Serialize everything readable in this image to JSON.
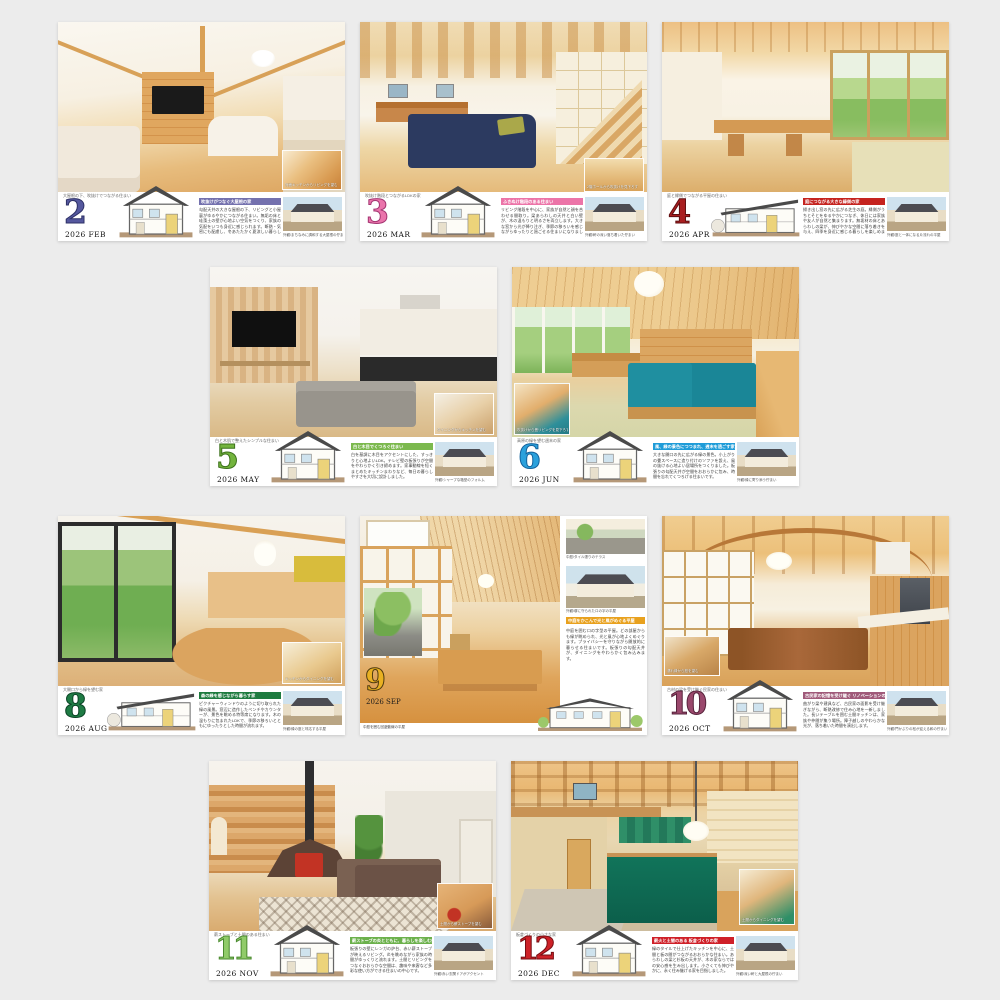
{
  "page": {
    "background": "#ececec",
    "year": "2026"
  },
  "cards": [
    {
      "month_number": "2",
      "date_label": "2026 FEB",
      "number_color": "#55589e",
      "number_outline": "#2e3166",
      "header_color": "#7471ae",
      "top_caption": "大屋根の下、吹抜けでつながる住まい",
      "headline": "吹抜けがつなぐ大屋根の家",
      "body": "勾配天井の大きな屋根の下、リビングと小屋裏がゆるやかにつながる住まい。無垢の床と珪藻土の壁が心地よい空気をつくり、家族の気配をいつも身近に感じられます。断熱・気密にも配慮し、冬あたたかく夏涼しい暮らしを実現しました。",
      "thumb_caption": "外観/まちなみに調和する大屋根の佇まい",
      "inset_caption": "対面キッチンからリビングを望む"
    },
    {
      "month_number": "3",
      "date_label": "2026 MAR",
      "number_color": "#ea74ab",
      "number_outline": "#a43572",
      "header_color": "#ec74a8",
      "top_caption": "吹抜け階段とつながるLDKの家",
      "headline": "ふきぬけ階段のある住まい",
      "body": "リビング階段を中心に、家族が自然と顔を合わせる間取り。梁あらわしの天井と白い壁が、木の温もりと明るさを両立します。大きな窓から光が降り注ぎ、季節の移ろいを感じながらゆったりと過ごせる住まいになりました。",
      "thumb_caption": "外観/軒の深い落ち着いた佇まい",
      "inset_caption": "2階ホールから吹抜けを見下ろす"
    },
    {
      "month_number": "4",
      "date_label": "2026 APR",
      "number_color": "#a91e20",
      "number_outline": "#5f0e10",
      "header_color": "#c5231f",
      "top_caption": "庭と縁側でつながる平屋の住まい",
      "headline": "庭につながる大きな縁側の家",
      "body": "掃き出し窓の先に広がる芝生の庭。縁側がうちとそとをゆるやかにつなぎ、休日には家族や友人が自然と集まります。無垢材の床とあらわしの梁が、伸びやかな空間に落ち着きを与え、四季を身近に感じる暮らしを楽しめます。",
      "thumb_caption": "外観/庭と一体になる片流れの平屋"
    },
    {
      "month_number": "5",
      "date_label": "2026 MAY",
      "number_color": "#73b43d",
      "number_outline": "#3c711c",
      "header_color": "#7cb94e",
      "top_caption": "白と木肌で整えたシンプルな住まい",
      "headline": "白と木目でくつろぐ住まい",
      "body": "白を基調に木目をアクセントにした、すっきりと心地よいLDK。テレビ壁の板張りが空間をやわらかく引き締めます。家事動線を短くまとめたキッチンまわりなど、毎日の暮らしやすさを大切に設計しました。",
      "thumb_caption": "外観/シャープな箱型のフォルム",
      "inset_caption": "ダイニングからキッチンを望む"
    },
    {
      "month_number": "6",
      "date_label": "2026 JUN",
      "number_color": "#2ba1dc",
      "number_outline": "#14629c",
      "header_color": "#1f9cd8",
      "top_caption": "高原の緑を望む週末の家",
      "headline": "風、緑の景色につつまれ、週末を過ごす家",
      "body": "大きな開口の先に広がる緑の景色。小上がりの畳スペースに造り付けのソファを設え、風の抜ける心地よい居場所をつくりました。板張りの勾配天井が空間をおおらかに包み、時間を忘れてくつろげる住まいです。",
      "thumb_caption": "外観/緑に寄り添う佇まい",
      "inset_caption": "吹抜けから畳リビングを見下ろす"
    },
    {
      "month_number": "8",
      "date_label": "2026 AUG",
      "number_color": "#1e7b44",
      "number_outline": "#0b4426",
      "header_color": "#1e7b3f",
      "top_caption": "大開口から緑を望む家",
      "headline": "森の緑を感じながら暮らす家",
      "body": "ピクチャーウィンドウのように切り取られた緑の風景。窓辺に造作したベンチやカウンターが、景色を眺める特等席になります。木の温もりに包まれたLDKで、季節の移ろいとともにゆったりとした時間が流れます。",
      "thumb_caption": "外観/緑の庭と呼応する平屋",
      "inset_caption": "キッチンからダイニングを望む"
    },
    {
      "month_number": "9",
      "date_label": "2026 SEP",
      "number_color": "#e9b122",
      "number_outline": "#4f3a0e",
      "header_color": "#e8a11e",
      "photo_caption": "中庭を囲む回遊動線の平屋",
      "headline": "中庭をかこんで光と風がめぐる平屋",
      "body": "中庭を囲むロの字型の平屋。どの部屋からも緑が眺められ、光と風が心地よくめぐります。プライバシーを守りながら開放的に暮らせる住まいです。板張りの勾配天井が、ダイニングをやわらかく包み込みます。",
      "thumb1_caption": "中庭/タイル張りのテラス",
      "thumb2_caption": "外観/塀に守られたロの字の平屋"
    },
    {
      "month_number": "10",
      "date_label": "2026 OCT",
      "number_color": "#9a486c",
      "number_outline": "#57243c",
      "header_color": "#a05a7a",
      "top_caption": "古材の梁を受け継ぐ民家の住まい",
      "headline": "古民家の記憶を受け継ぐ リノベーションの家",
      "body": "曲がり梁や建具など、古民家の面影を受け継ぎながら、断熱改修で住み心地を一新しました。長いテーブルを囲む土間キッチンは、家族や仲間が集う場所。障子越しのやわらかな光が、落ち着いた時間を演出します。",
      "thumb_caption": "外観/門かぶりの松が迎える和の佇まい",
      "inset_caption": "濡れ縁から庭を望む"
    },
    {
      "month_number": "11",
      "date_label": "2026 NOV",
      "number_color": "#90cb69",
      "number_outline": "#49892e",
      "header_color": "#6cb14c",
      "top_caption": "薪ストーブと土間のある住まい",
      "headline": "薪ストーブの炎とともに、暮らしを楽しむ住まい",
      "body": "板張りの壁にレンガの炉台、赤い薪ストーブが映えるリビング。炎を眺めながら家族の時間がゆっくりと流れます。土間とリビングをつなぐおおらかな空間は、趣味や来客など多彩な使い方ができる住まいの中心です。",
      "thumb_caption": "外観/赤い玄関ドアがアクセント",
      "inset_caption": "土間から薪ストーブを望む"
    },
    {
      "month_number": "12",
      "date_label": "2026 DEC",
      "number_color": "#cd2127",
      "number_outline": "#760d12",
      "header_color": "#cf2028",
      "top_caption": "板倉づくりの小さな家",
      "headline": "薪火と土間のある 板倉づくりの家",
      "body": "緑のタイルで仕上げたキッチンを中心に、土間と板の間がつながるおおらかな住まい。あらわしの梁と杉板の天井が、木の家ならではの安心感を生み出します。小さくても伸びやかに、永く住み継げる家を目指しました。",
      "thumb_caption": "外観/深い軒と大屋根の佇まい",
      "inset_caption": "土間からダイニングを望む"
    }
  ]
}
